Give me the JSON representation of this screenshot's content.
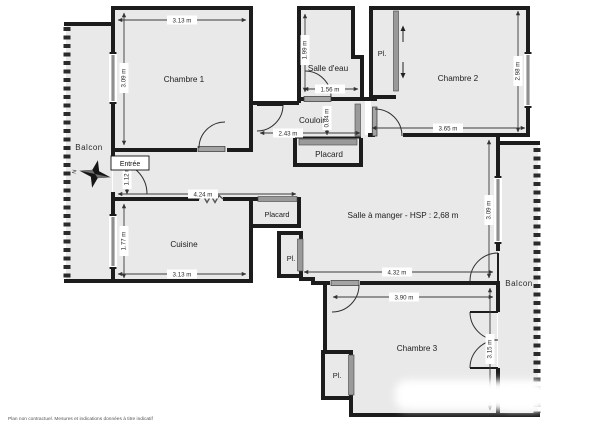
{
  "plan": {
    "disclaimer": "Plan non contractuel. Mesures et indications données à titre indicatif",
    "compass_letter": "N",
    "colors": {
      "floor": "#e9e9e9",
      "wall": "#1c1c1c",
      "dim": "#3a3a3a",
      "door": "#9a9a9a"
    },
    "rooms": {
      "chambre1": {
        "label": "Chambre 1"
      },
      "chambre2": {
        "label": "Chambre 2"
      },
      "chambre3": {
        "label": "Chambre 3"
      },
      "salle_eau": {
        "label": "Salle d'eau"
      },
      "couloir": {
        "label": "Couloir"
      },
      "cuisine": {
        "label": "Cuisine"
      },
      "salle_a_manger": {
        "label": "Salle à manger - HSP : 2,68 m"
      },
      "entree": {
        "label": "Entrée"
      },
      "placard_mid": {
        "label": "Placard"
      },
      "placard_left": {
        "label": "Placard"
      },
      "pl_chambre2": {
        "label": "Pl."
      },
      "pl_sam": {
        "label": "Pl."
      },
      "pl_chambre3": {
        "label": "Pl."
      },
      "balcon_gauche": {
        "label": "Balcon"
      },
      "balcon_droit": {
        "label": "Balcon"
      }
    },
    "dims": {
      "chambre1_w": "3.13 m",
      "chambre1_h": "3.09 m",
      "salle_eau_h": "1.99 m",
      "salle_eau_w": "1.56 m",
      "couloir_w": "2.43 m",
      "couloir_h": "0.84 m",
      "chambre2_w": "3.65 m",
      "chambre2_h": "2.98 m",
      "entree_h": "1.12 m",
      "degagement_w": "4.24 m",
      "cuisine_h": "1.77 m",
      "cuisine_w": "3.13 m",
      "sam_w": "4.32 m",
      "sam_h": "3.09 m",
      "chambre3_w": "3.90 m",
      "chambre3_h": "3.15 m"
    }
  }
}
